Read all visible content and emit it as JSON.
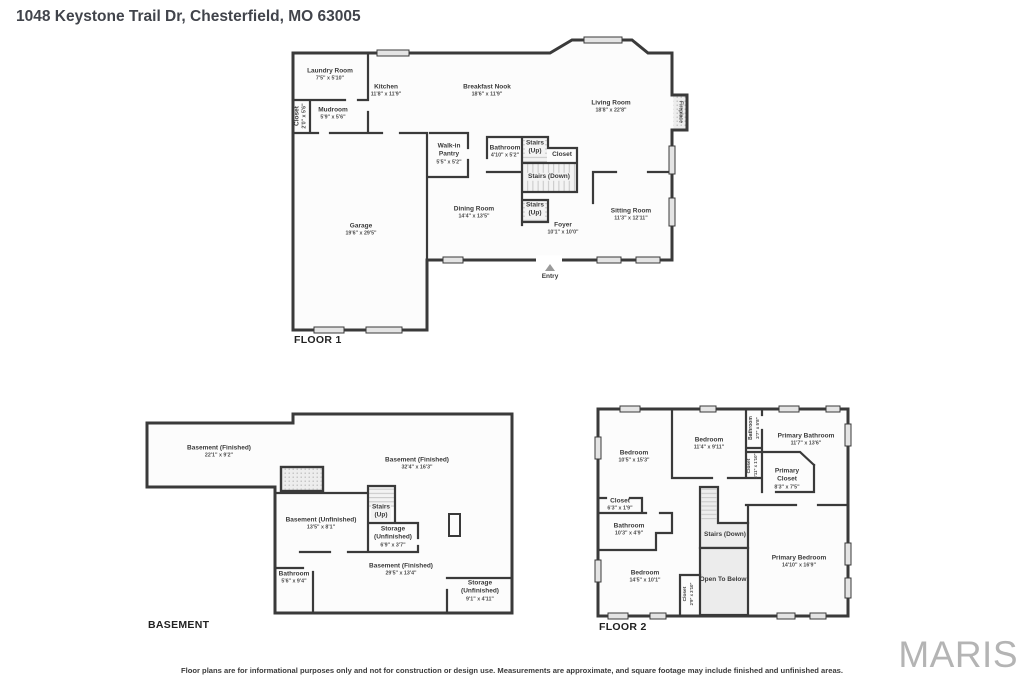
{
  "page": {
    "title": "1048 Keystone Trail Dr, Chesterfield, MO 63005",
    "disclaimer": "Floor plans are for informational purposes only and not for construction or design use. Measurements are approximate, and square footage may include finished and unfinished areas.",
    "watermark": "MARIS"
  },
  "floor1": {
    "label": "FLOOR 1",
    "entry_label": "Entry",
    "rooms": [
      {
        "name": "Laundry Room",
        "dims": "7'5\" x 5'10\""
      },
      {
        "name": "Closet",
        "dims": "2'0\" x 5'6\""
      },
      {
        "name": "Mudroom",
        "dims": "5'9\" x 5'6\""
      },
      {
        "name": "Kitchen",
        "dims": "11'8\" x 11'9\""
      },
      {
        "name": "Breakfast Nook",
        "dims": "18'6\" x 11'9\""
      },
      {
        "name": "Living Room",
        "dims": "18'8\" x 22'8\""
      },
      {
        "name": "Fireplace"
      },
      {
        "name": "Walk-in Pantry",
        "dims": "5'5\" x 5'2\""
      },
      {
        "name": "Bathroom",
        "dims": "4'10\" x 5'2\""
      },
      {
        "name": "Stairs",
        "sub": "(Up)"
      },
      {
        "name": "Closet"
      },
      {
        "name": "Stairs (Down)"
      },
      {
        "name": "Stairs",
        "sub": "(Up)"
      },
      {
        "name": "Dining Room",
        "dims": "14'4\" x 13'5\""
      },
      {
        "name": "Foyer",
        "dims": "10'1\" x 10'0\""
      },
      {
        "name": "Sitting Room",
        "dims": "11'3\" x 12'11\""
      },
      {
        "name": "Garage",
        "dims": "19'6\" x 29'5\""
      }
    ]
  },
  "basement": {
    "label": "BASEMENT",
    "rooms": [
      {
        "name": "Basement (Finished)",
        "dims": "22'1\" x 9'2\""
      },
      {
        "name": "Basement (Finished)",
        "dims": "32'4\" x 16'3\""
      },
      {
        "name": "Basement (Unfinished)",
        "dims": "13'5\" x 8'1\""
      },
      {
        "name": "Stairs",
        "sub": "(Up)"
      },
      {
        "name": "Storage",
        "sub": "(Unfinished)",
        "dims": "6'9\" x 3'7\""
      },
      {
        "name": "Bathroom",
        "dims": "5'6\" x 9'4\""
      },
      {
        "name": "Basement (Finished)",
        "dims": "29'5\" x 13'4\""
      },
      {
        "name": "Storage",
        "sub": "(Unfinished)",
        "dims": "9'1\" x 4'11\""
      }
    ]
  },
  "floor2": {
    "label": "FLOOR 2",
    "rooms": [
      {
        "name": "Bedroom",
        "dims": "10'5\" x 15'3\""
      },
      {
        "name": "Bedroom",
        "dims": "11'4\" x 9'11\""
      },
      {
        "name": "Bathroom",
        "dims": "2'7\" x 5'8\""
      },
      {
        "name": "Primary Bathroom",
        "dims": "11'7\" x 13'6\""
      },
      {
        "name": "Closet",
        "dims": "2'11\" x 1'10\""
      },
      {
        "name": "Primary Closet",
        "dims": "8'3\" x 7'5\""
      },
      {
        "name": "Closet",
        "dims": "6'3\" x 1'9\""
      },
      {
        "name": "Bathroom",
        "dims": "10'3\" x 4'9\""
      },
      {
        "name": "Stairs (Down)"
      },
      {
        "name": "Open To Below"
      },
      {
        "name": "Bedroom",
        "dims": "14'5\" x 10'1\""
      },
      {
        "name": "Closet",
        "dims": "2'9\" x 3'10\""
      },
      {
        "name": "Primary Bedroom",
        "dims": "14'10\" x 16'9\""
      }
    ]
  }
}
